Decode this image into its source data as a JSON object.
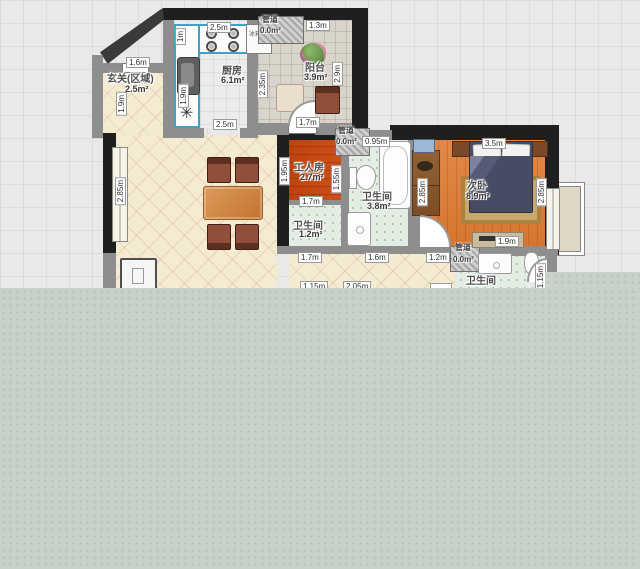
{
  "palette": {
    "wall_black": "#1f1f1f",
    "wall_gray": "#8e8e8e",
    "floor_cream": "#f4ebd2",
    "floor_wood": "#de8140",
    "floor_bath_green": "#e4ede4",
    "floor_kitchen": "#ececea",
    "floor_balcony": "#dad5ca",
    "overlay_gray": "#c8d2cb",
    "selected_counter_outline": "#3fa0c8",
    "bed_blanket_navy": "#474b63",
    "rug_tan": "#c9a96b"
  },
  "rooms": [
    {
      "id": "entrance",
      "name": "玄关(区域)",
      "area": "2.5m²"
    },
    {
      "id": "kitchen",
      "name": "厨房",
      "area": "6.1m²"
    },
    {
      "id": "balcony",
      "name": "阳台",
      "area": "3.9m²"
    },
    {
      "id": "worker-room",
      "name": "工人房",
      "area": "2.7m²"
    },
    {
      "id": "bathroom-middle",
      "name": "卫生间",
      "area": "3.8m²"
    },
    {
      "id": "bathroom-small",
      "name": "卫生间",
      "area": "1.2m²"
    },
    {
      "id": "bedroom-second",
      "name": "次卧",
      "area": "8.9m²"
    },
    {
      "id": "bathroom-right",
      "name": "卫生间",
      "area": ""
    }
  ],
  "pipes": [
    {
      "name": "管道",
      "area": "0.0m²"
    },
    {
      "name": "管道",
      "area": "0.0m²"
    },
    {
      "name": "管道",
      "area": "0.0m²"
    }
  ],
  "appliances": {
    "fridge": "冰箱"
  },
  "dimensions": [
    {
      "text": "2.5m",
      "x": 207,
      "y": 22,
      "o": "h"
    },
    {
      "text": "1m",
      "x": 175,
      "y": 28,
      "o": "v"
    },
    {
      "text": "1.9m",
      "x": 178,
      "y": 84,
      "o": "v"
    },
    {
      "text": "2.5m",
      "x": 213,
      "y": 119,
      "o": "h"
    },
    {
      "text": "2.35m",
      "x": 257,
      "y": 70,
      "o": "v"
    },
    {
      "text": "1.3m",
      "x": 306,
      "y": 20,
      "o": "h"
    },
    {
      "text": "2.9m",
      "x": 332,
      "y": 62,
      "o": "v"
    },
    {
      "text": "1.7m",
      "x": 296,
      "y": 117,
      "o": "h"
    },
    {
      "text": "0.95m",
      "x": 362,
      "y": 136,
      "o": "h"
    },
    {
      "text": "1.95m",
      "x": 279,
      "y": 157,
      "o": "v"
    },
    {
      "text": "1.55m",
      "x": 331,
      "y": 165,
      "o": "v"
    },
    {
      "text": "1.6m",
      "x": 126,
      "y": 57,
      "o": "h"
    },
    {
      "text": "1.9m",
      "x": 116,
      "y": 92,
      "o": "v"
    },
    {
      "text": "2.85m",
      "x": 115,
      "y": 177,
      "o": "v"
    },
    {
      "text": "3.5m",
      "x": 482,
      "y": 138,
      "o": "h"
    },
    {
      "text": "2.85m",
      "x": 417,
      "y": 178,
      "o": "v"
    },
    {
      "text": "2.85m",
      "x": 536,
      "y": 178,
      "o": "v"
    },
    {
      "text": "1.7m",
      "x": 299,
      "y": 196,
      "o": "h"
    },
    {
      "text": "1.9m",
      "x": 495,
      "y": 236,
      "o": "h"
    },
    {
      "text": "1.2m",
      "x": 426,
      "y": 252,
      "o": "h"
    },
    {
      "text": "1.7m",
      "x": 298,
      "y": 252,
      "o": "h"
    },
    {
      "text": "1.6m",
      "x": 365,
      "y": 252,
      "o": "h"
    },
    {
      "text": "1.15m",
      "x": 300,
      "y": 281,
      "o": "h"
    },
    {
      "text": "2.05m",
      "x": 343,
      "y": 281,
      "o": "h"
    },
    {
      "text": "",
      "x": 430,
      "y": 283,
      "o": "h"
    },
    {
      "text": "1.15m",
      "x": 535,
      "y": 263,
      "o": "v"
    }
  ]
}
